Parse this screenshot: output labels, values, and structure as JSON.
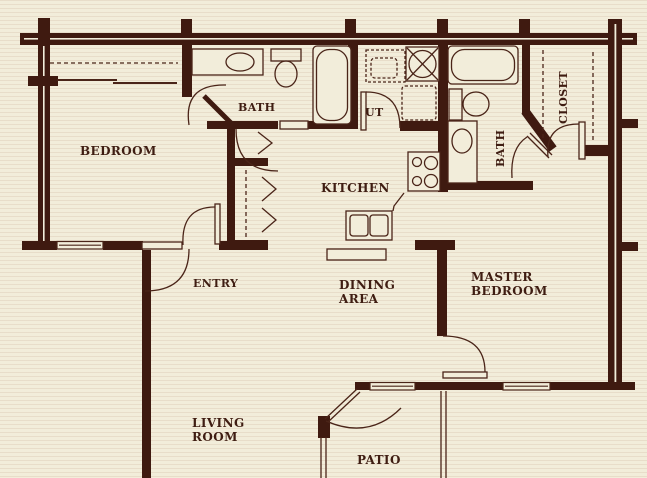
{
  "title": "Apartment floor plan",
  "palette": {
    "background": "#f2edda",
    "wall": "#3f1a10",
    "line": "#4a2418",
    "text": "#3f1d12"
  },
  "rooms": {
    "bedroom": {
      "label": "BEDROOM"
    },
    "bath1": {
      "label": "BATH"
    },
    "utility": {
      "label": "UT"
    },
    "kitchen": {
      "label": "KITCHEN"
    },
    "bath2": {
      "label": "BATH"
    },
    "closet": {
      "label": "CLOSET"
    },
    "entry": {
      "label": "ENTRY"
    },
    "dining": {
      "line1": "DINING",
      "line2": "AREA"
    },
    "master": {
      "line1": "MASTER",
      "line2": "BEDROOM"
    },
    "living": {
      "line1": "LIVING",
      "line2": "ROOM"
    },
    "patio": {
      "label": "PATIO"
    }
  },
  "fixtures": [
    "bedroom-closet-sliding-doors",
    "bath1-vanity-sink",
    "bath1-toilet",
    "bath1-bathtub",
    "utility-washer",
    "utility-dashed-appliances",
    "kitchen-stove-4-burners",
    "kitchen-double-sink",
    "kitchen-bar-counter",
    "hall-linen-closets-bifold-doors",
    "bath2-bathtub",
    "bath2-toilet",
    "bath2-vanity-sink",
    "master-closet-rods",
    "patio-railing",
    "windows",
    "door-swings"
  ]
}
